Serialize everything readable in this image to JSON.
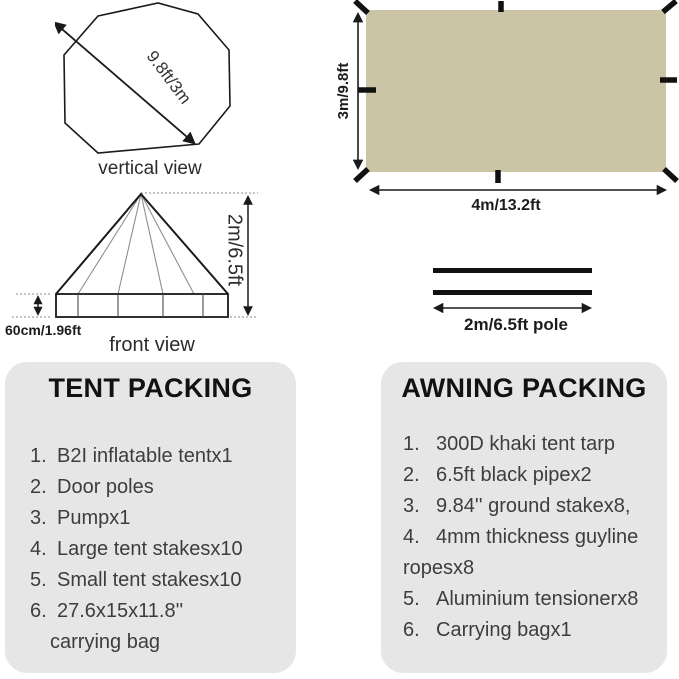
{
  "colors": {
    "tarp_fill": "#cbc5a6",
    "panel_bg": "#e7e6e6",
    "line": "#1a1a1a",
    "list_text": "#3d3d3d"
  },
  "vertical_view": {
    "dimension_label": "9.8ft/3m",
    "caption": "vertical view"
  },
  "front_view": {
    "height_label": "2m/6.5ft",
    "base_label": "60cm/1.96ft",
    "caption": "front view"
  },
  "tarp": {
    "height_label": "3m/9.8ft",
    "width_label": "4m/13.2ft"
  },
  "poles": {
    "label": "2m/6.5ft pole"
  },
  "tent_packing": {
    "title": "TENT PACKING",
    "items": [
      {
        "num": "1.",
        "text": "B2I inflatable tentx1"
      },
      {
        "num": "2.",
        "text": "Door poles"
      },
      {
        "num": "3.",
        "text": "Pumpx1"
      },
      {
        "num": "4.",
        "text": "Large tent stakesx10"
      },
      {
        "num": "5.",
        "text": "Small tent stakesx10"
      },
      {
        "num": "6.",
        "text": "27.6x15x11.8''"
      },
      {
        "num": "",
        "text": "carrying bag",
        "indent": true
      }
    ]
  },
  "awning_packing": {
    "title": "AWNING PACKING",
    "items": [
      {
        "num": "1.",
        "text": "300D khaki tent tarp"
      },
      {
        "num": "2.",
        "text": "6.5ft black pipex2"
      },
      {
        "num": "3.",
        "text": "9.84'' ground stakex8,"
      },
      {
        "num": "4.",
        "text": "4mm thickness guyline"
      },
      {
        "num": "",
        "text": "ropesx8"
      },
      {
        "num": "5.",
        "text": "Aluminium tensionerx8"
      },
      {
        "num": "6.",
        "text": "Carrying bagx1"
      }
    ]
  }
}
